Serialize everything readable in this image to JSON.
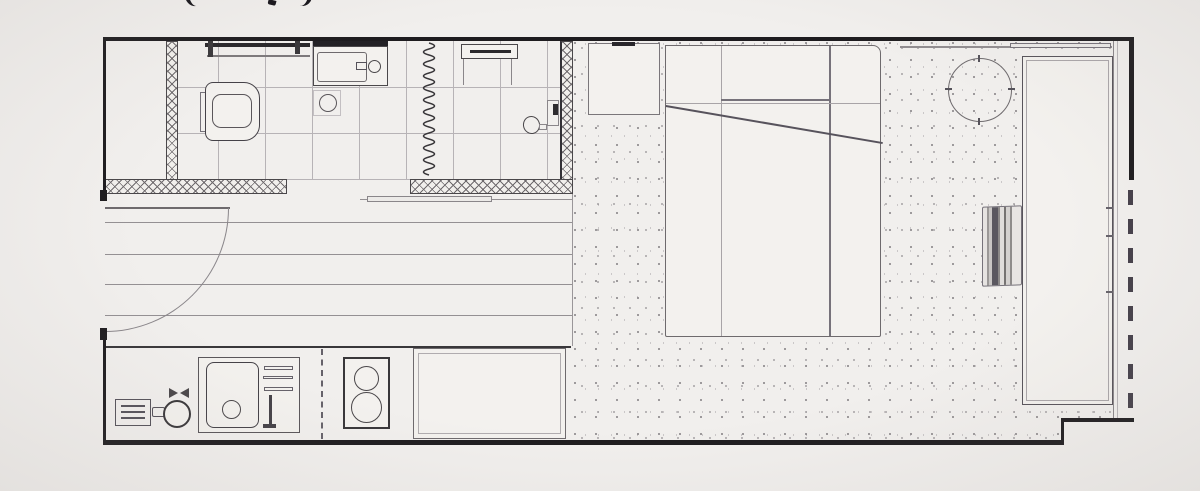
{
  "page": {
    "kind": "architectural floor plan",
    "subject": "studio apartment plan view",
    "background_color": "#f1efed"
  },
  "cropped_title": {
    "fragments_visible": 3,
    "note_glyphs": "( , )"
  },
  "colors": {
    "wall": "#1e1c1f",
    "medium_line": "#55525a",
    "light_line": "#a29ea1",
    "tile_line": "#b7b3b6",
    "window_dash": "#45404a",
    "stipple_dot": "#8d898c"
  },
  "labels": {
    "bathroom": "bathroom (tiled floor)",
    "closet": "entry closet",
    "towel_rail": "towel rail with brackets",
    "vanity": "vanity sink with faucet",
    "toilet": "toilet",
    "drain": "floor drain",
    "accordion": "accordion shower partition",
    "niche": "shower shelf niche",
    "shower": "wall-mounted shower fixture",
    "threshold": "sliding door threshold",
    "hall": "entry hall with plank flooring",
    "door": "entry door (90° swing)",
    "kitchen": "kitchen counter run",
    "outlet": "appliance panel",
    "kettle": "kettle",
    "ksink": "kitchen sink with drain",
    "rack": "dish rack and faucet",
    "divider": "counter divider (dashed)",
    "stove": "two-burner stove",
    "fridge": "fridge / cabinet unit",
    "bedroom": "sleeping and living area (stippled floor)",
    "nightstand": "nightstand",
    "bed": "double bed with pillow and folded blanket",
    "table": "round table",
    "desk": "long desk counter",
    "chair": "slatted chair",
    "window": "window line (dashed) and glazed wall",
    "walls": "exterior and partition walls"
  },
  "inventory": {
    "rooms": [
      "bathroom",
      "entry-hall",
      "kitchen",
      "living-sleeping-area"
    ],
    "fixture_counts": {
      "stove_burners": 2,
      "plank_floor_lines": 5,
      "bathroom_zones": 2,
      "desk_edge_ticks": 3
    }
  }
}
